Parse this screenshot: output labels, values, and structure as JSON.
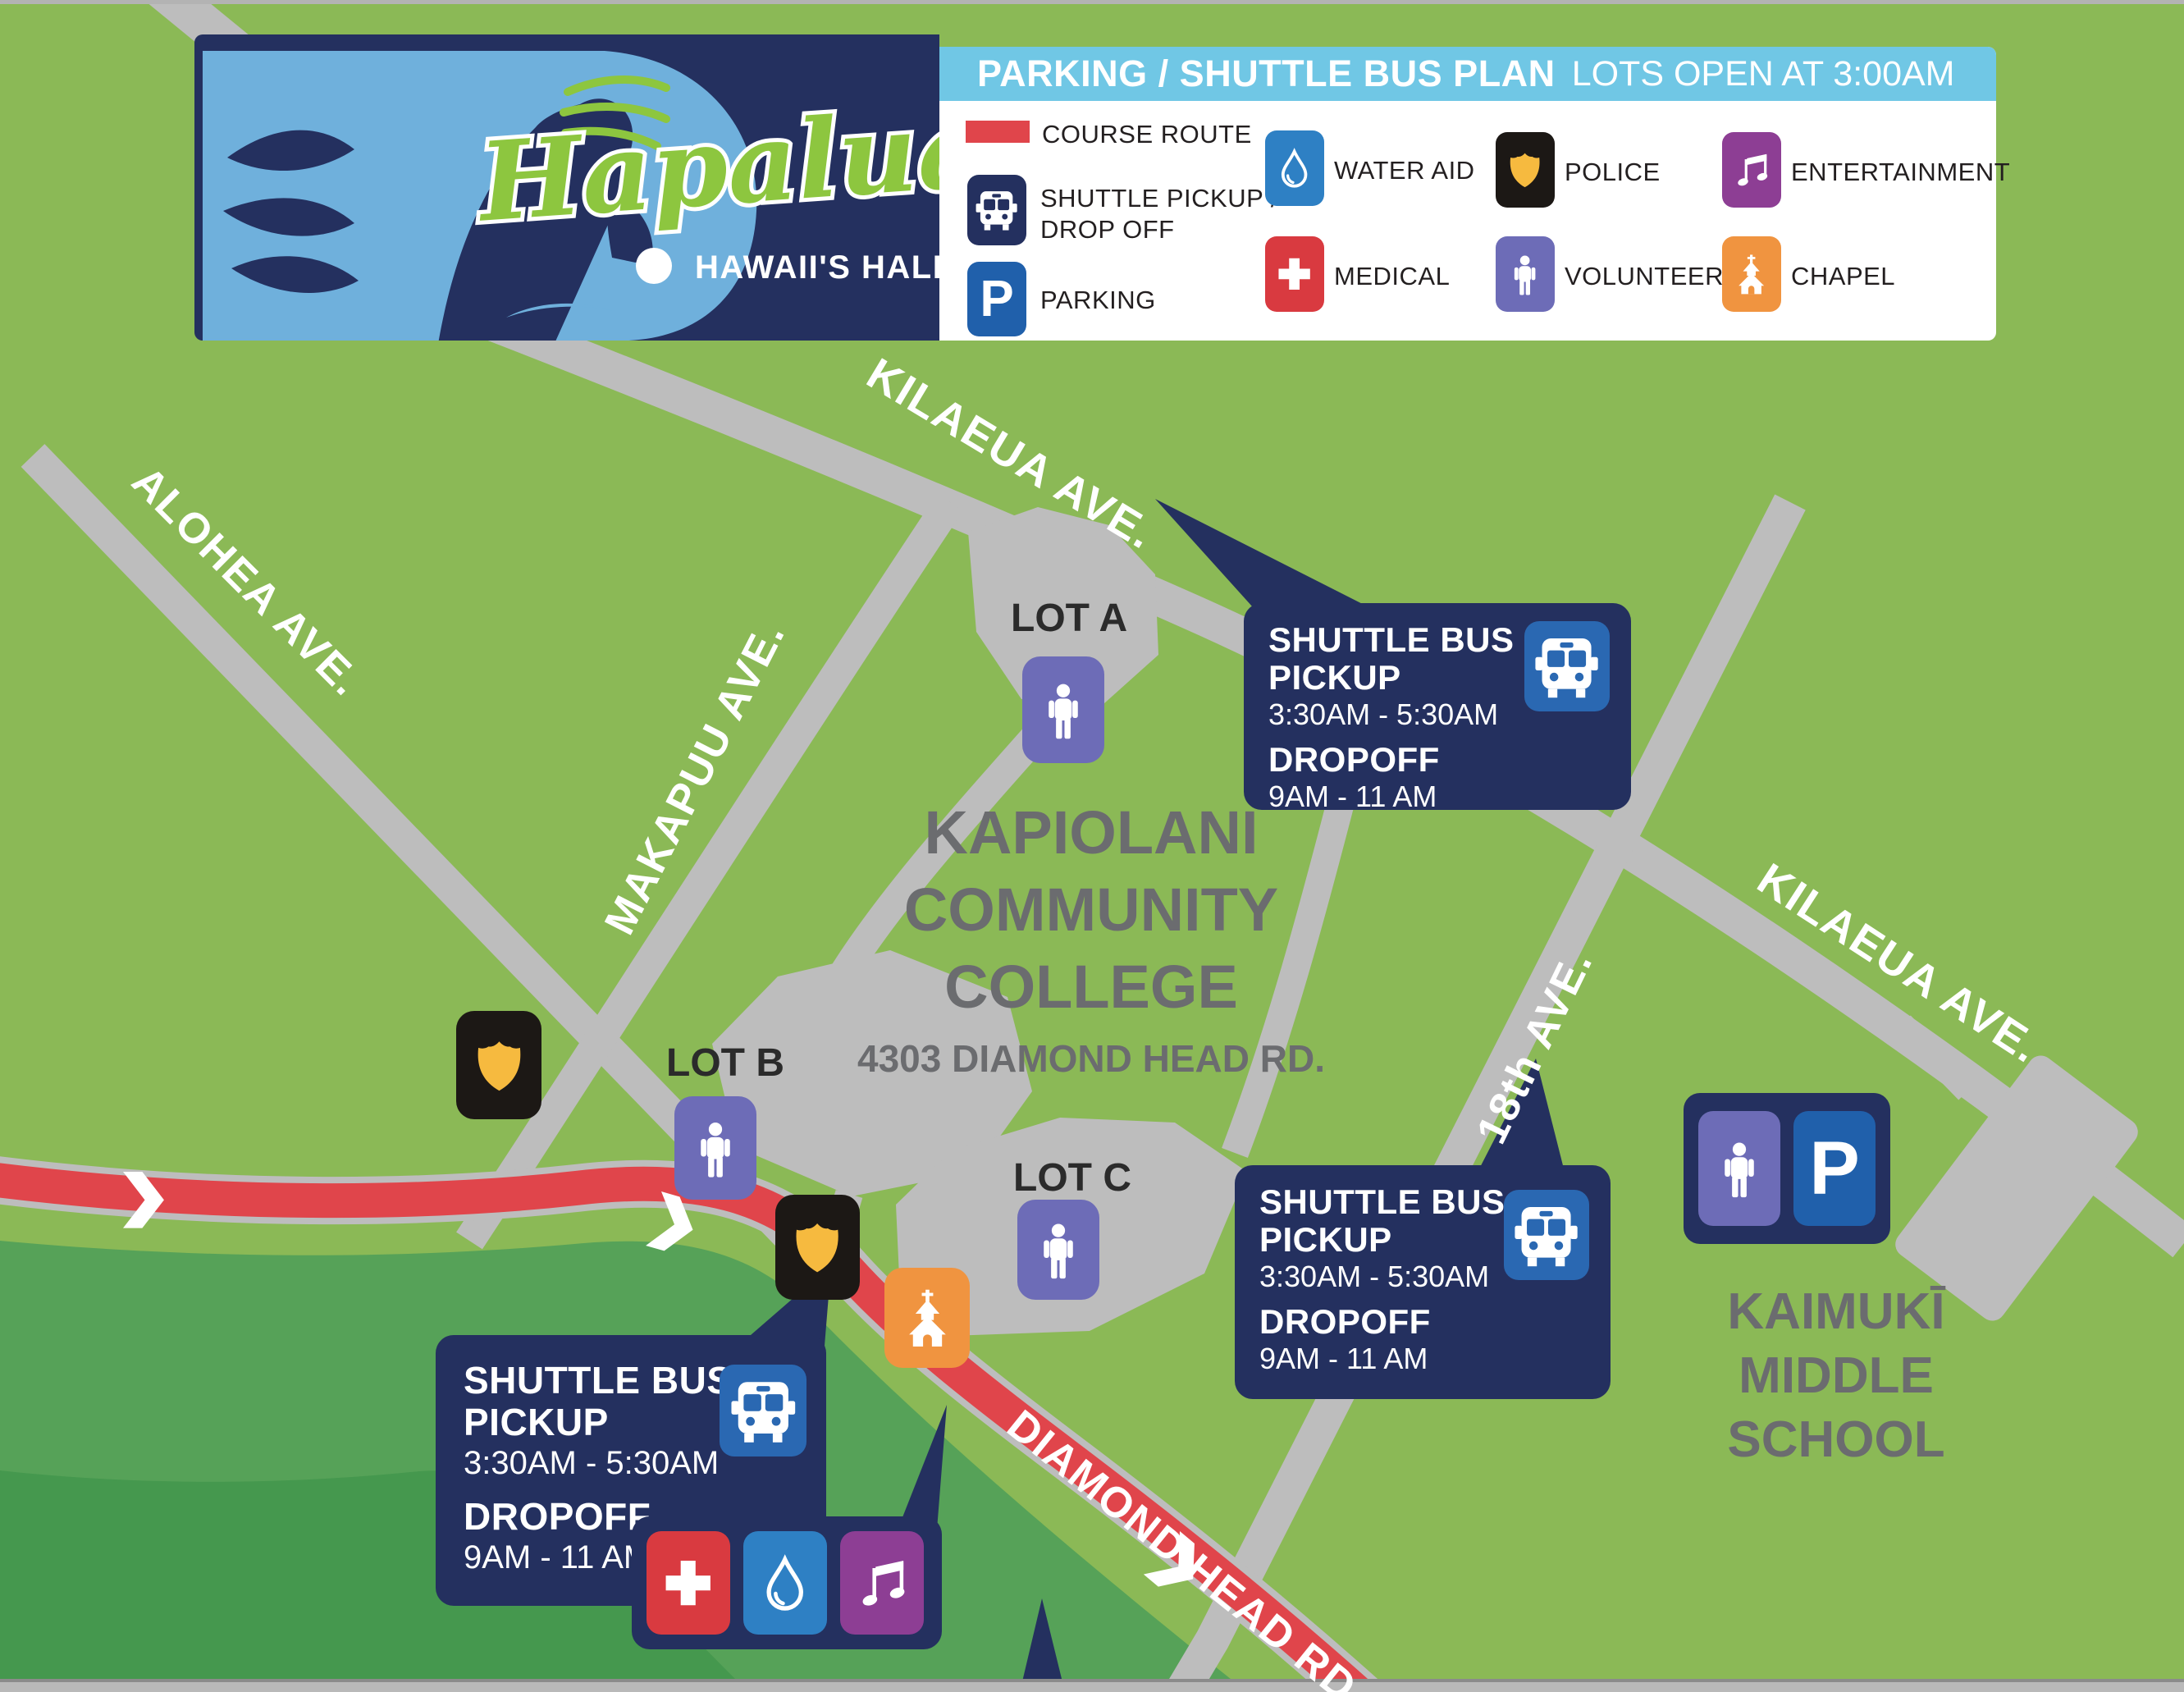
{
  "banner": {
    "logo": {
      "script": "Hapalua",
      "subtitle": "HAWAII'S HALF-MARATHON"
    },
    "title_bar": {
      "title": "PARKING / SHUTTLE BUS PLAN",
      "note": "LOTS OPEN AT 3:00AM"
    },
    "legend": {
      "course_route": "COURSE ROUTE",
      "shuttle_line1": "SHUTTLE PICKUP /",
      "shuttle_line2": "DROP OFF",
      "parking": "PARKING",
      "water_aid": "WATER AID",
      "medical": "MEDICAL",
      "police": "POLICE",
      "volunteer": "VOLUNTEER",
      "entertainment": "ENTERTAINMENT",
      "chapel": "CHAPEL"
    }
  },
  "icons": {
    "parking_letter": "P"
  },
  "map": {
    "streets": {
      "kilauea_top": "KILAEUA AVE.",
      "alohea": "ALOHEA AVE.",
      "makapuu": "MAKAPUU AVE.",
      "eighteenth": "18th AVE.",
      "kilauea_right": "KILAEUA AVE.",
      "diamond_head": "DIAMOND HEAD RD."
    },
    "places": {
      "kcc_line1": "KAPIOLANI",
      "kcc_line2": "COMMUNITY",
      "kcc_line3": "COLLEGE",
      "kcc_address": "4303 DIAMOND HEAD RD.",
      "kaimuki_line1": "KAIMUKĪ",
      "kaimuki_line2": "MIDDLE",
      "kaimuki_line3": "SCHOOL"
    },
    "lots": {
      "a": "LOT A",
      "b": "LOT B",
      "c": "LOT C"
    },
    "callouts": [
      {
        "title_line1": "SHUTTLE BUS",
        "title_line2": "PICKUP",
        "pickup_time": "3:30AM - 5:30AM",
        "dropoff_label": "DROPOFF",
        "dropoff_time": "9AM - 11 AM"
      },
      {
        "title_line1": "SHUTTLE BUS",
        "title_line2": "PICKUP",
        "pickup_time": "3:30AM - 5:30AM",
        "dropoff_label": "DROPOFF",
        "dropoff_time": "9AM - 11 AM"
      },
      {
        "title_line1": "SHUTTLE BUS",
        "title_line2": "PICKUP",
        "pickup_time": "3:30AM - 5:30AM",
        "dropoff_label": "DROPOFF",
        "dropoff_time": "9AM - 11 AM"
      }
    ]
  },
  "colors": {
    "map_green": "#8bb956",
    "band_green_mid": "#56a258",
    "band_green_dark": "#45984e",
    "road_gray": "#bdbdbd",
    "route_red": "#e0454b",
    "navy": "#24305f",
    "sky_blue": "#70c7e5",
    "police_gold": "#f6ba3f",
    "volunteer_purple": "#6d6cb7",
    "entertainment_purple": "#8d3e94",
    "chapel_orange": "#f09440",
    "water_blue": "#2e80c4",
    "medical_red": "#d93a40",
    "parking_blue": "#2060ab"
  }
}
